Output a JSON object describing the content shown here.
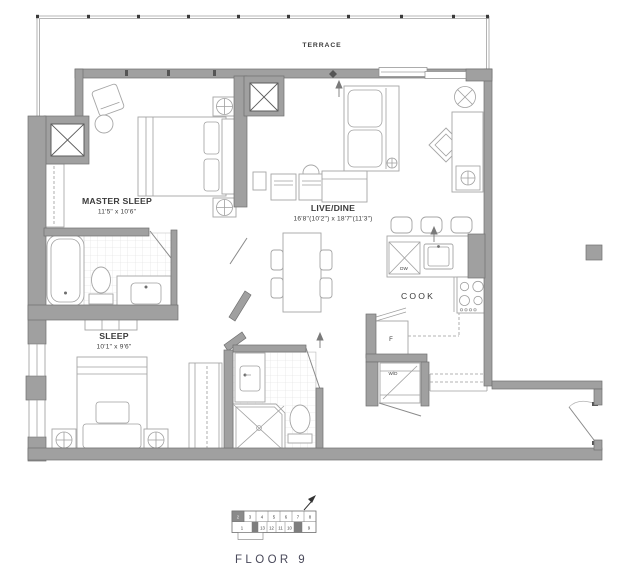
{
  "floorplan": {
    "terrace_label": "TERRACE",
    "rooms": {
      "master_sleep": {
        "name": "MASTER SLEEP",
        "dims": "11'5\" x 10'6\""
      },
      "live_dine": {
        "name": "LIVE/DINE",
        "dims": "16'8\"(10'2\") x 18'7\"(11'3\")"
      },
      "sleep": {
        "name": "SLEEP",
        "dims": "10'1\" x 9'6\""
      },
      "cook": {
        "name": "COOK"
      }
    },
    "appliances": {
      "fridge": "F",
      "dishwasher": "DW",
      "washer_dryer": "W/D"
    },
    "floor_label": "FLOOR 9"
  },
  "keyplan": {
    "top_units": [
      "2",
      "3",
      "4",
      "5",
      "6",
      "7",
      "8"
    ],
    "bottom_units": [
      "1",
      "13",
      "12",
      "11",
      "10",
      "9"
    ],
    "highlighted_unit": "2"
  },
  "colors": {
    "wall": "#a0a0a0",
    "wall_outline": "#6f6f6f",
    "drawing_line": "#8f8f8f",
    "text": "#3b3b3b",
    "keyplan_highlight": "#8a8a8a"
  }
}
